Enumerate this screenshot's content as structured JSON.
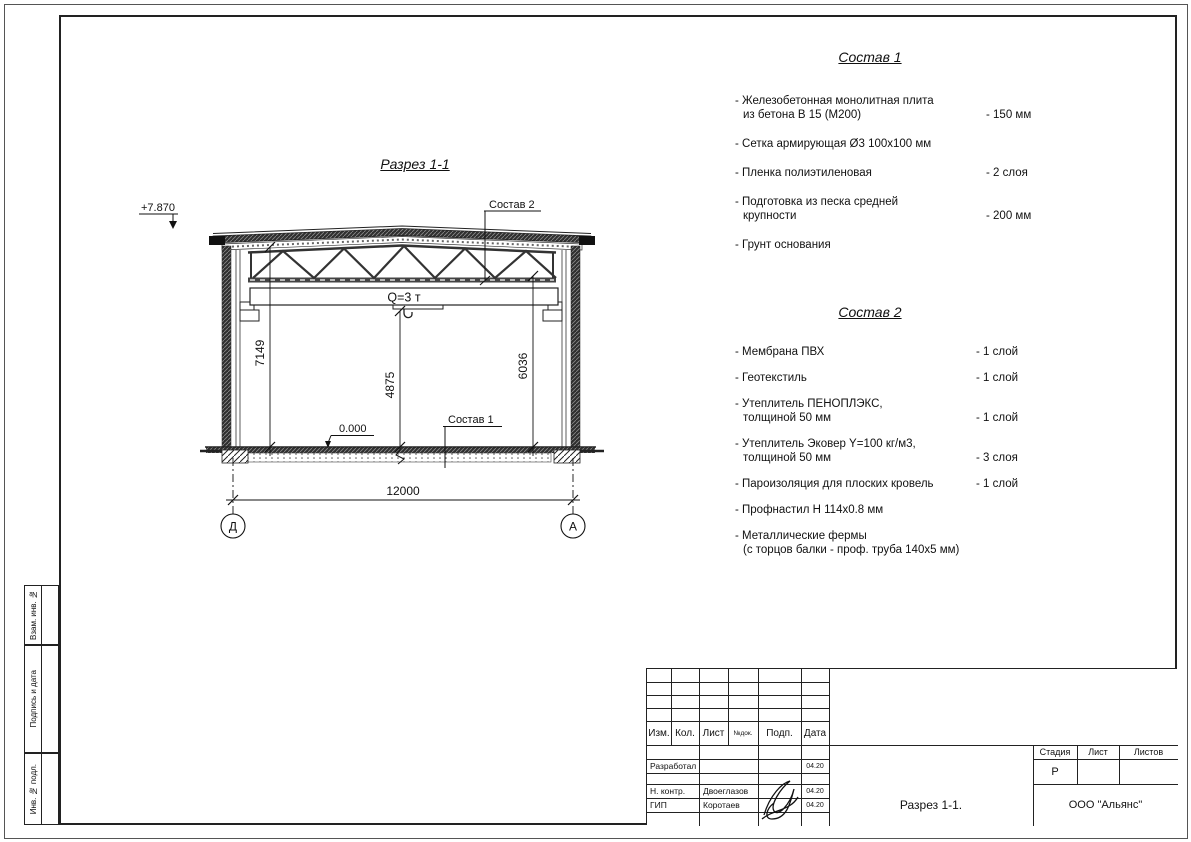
{
  "drawing": {
    "title": "Разрез 1-1",
    "elevation_mark": "+7.870",
    "level_mark": "0.000",
    "crane_capacity": "Q=3 т",
    "callout_sostav1": "Состав 1",
    "callout_sostav2": "Состав 2",
    "dim_height_left": "7149",
    "dim_height_center": "4875",
    "dim_height_right": "6036",
    "dim_width": "12000",
    "axis_left": "Д",
    "axis_right": "А"
  },
  "sostav1": {
    "title": "Состав 1",
    "items": [
      {
        "name": "- Железобетонная  монолитная плита\nиз бетона В 15 (М200)",
        "value": "- 150 мм"
      },
      {
        "name": "- Сетка армирующая Ø3 100х100 мм",
        "value": ""
      },
      {
        "name": "- Пленка полиэтиленовая",
        "value": "-  2 слоя"
      },
      {
        "name": "- Подготовка из песка средней\nкрупности",
        "value": "- 200 мм"
      },
      {
        "name": "- Грунт основания",
        "value": ""
      }
    ]
  },
  "sostav2": {
    "title": "Состав 2",
    "items": [
      {
        "name": "- Мембрана ПВХ",
        "value": "- 1 слой"
      },
      {
        "name": "- Геотекстиль",
        "value": "- 1 слой"
      },
      {
        "name": "- Утеплитель ПЕНОПЛЭКС,\nтолщиной 50 мм",
        "value": "- 1 слой"
      },
      {
        "name": "- Утеплитель Эковер Y=100 кг/м3,\nтолщиной 50 мм",
        "value": "- 3 слоя"
      },
      {
        "name": "- Пароизоляция для плоских кровель",
        "value": "- 1 слой"
      },
      {
        "name": "- Профнастил Н 114х0.8 мм",
        "value": ""
      },
      {
        "name": "- Металлические фермы\n(с торцов балки - проф. труба 140х5 мм)",
        "value": ""
      }
    ]
  },
  "title_block": {
    "header": {
      "izm": "Изм.",
      "kol": "Кол.",
      "list": "Лист",
      "ndok": "№док.",
      "podp": "Подп.",
      "data": "Дата"
    },
    "rows": [
      {
        "role": "Разработал",
        "name": "",
        "date": "04.20"
      },
      {
        "role": "Н. контр.",
        "name": "Двоеглазов",
        "date": "04.20"
      },
      {
        "role": "ГИП",
        "name": "Коротаев",
        "date": "04.20"
      }
    ],
    "stage_label": "Стадия",
    "sheet_label": "Лист",
    "sheets_label": "Листов",
    "stage_value": "Р",
    "doc_title": "Разрез 1-1.",
    "company": "ООО \"Альянс\""
  },
  "margin_labels": [
    "Взам. инв. №",
    "Подпись и дата",
    "Инв. № подл."
  ]
}
